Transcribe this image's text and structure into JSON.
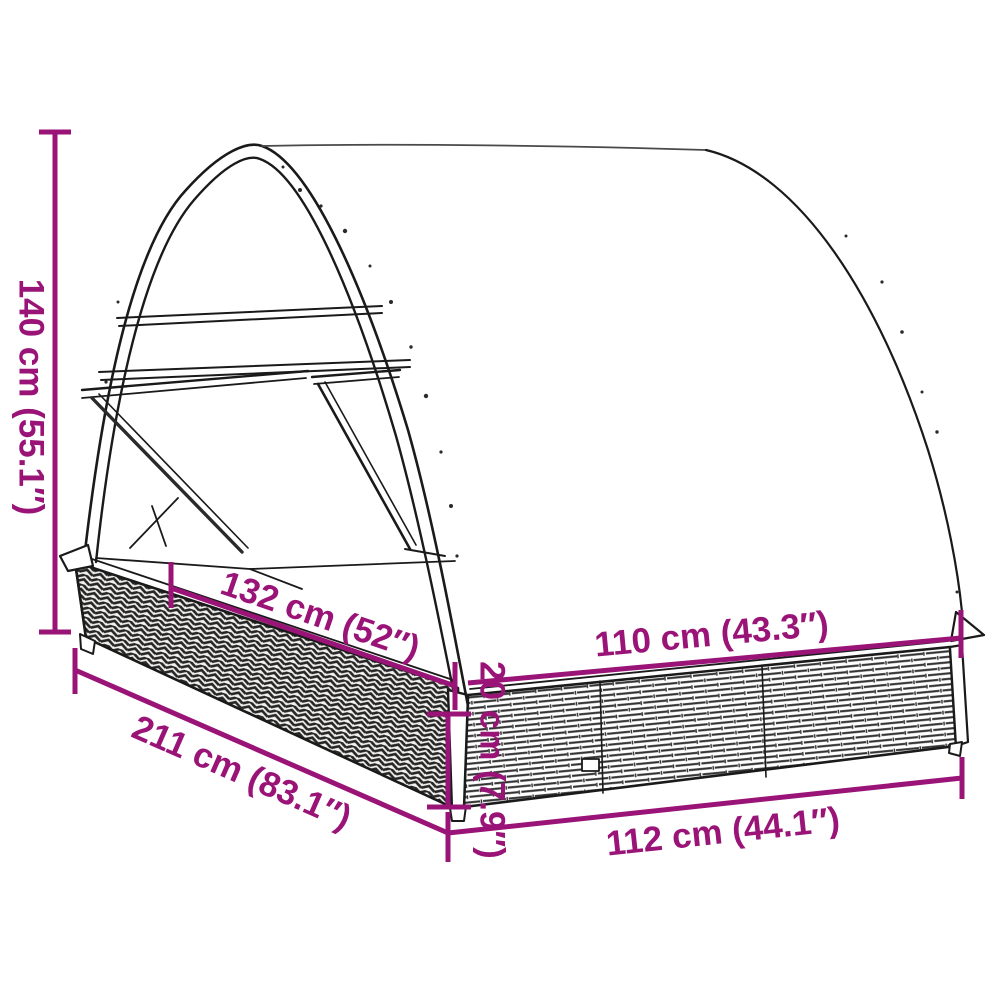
{
  "diagram": {
    "subject": "double-sun-lounger-with-round-canopy-dimension-drawing",
    "background": "#ffffff",
    "accent_color": "#9a1478",
    "line_color": "#1a1a1a",
    "dimensions": [
      {
        "id": "overall-height",
        "label": "140 cm (55.1″)",
        "value_cm": 140,
        "value_in": 55.1
      },
      {
        "id": "inner-length",
        "label": "132 cm (52″)",
        "value_cm": 132,
        "value_in": 52
      },
      {
        "id": "inner-width",
        "label": "110 cm (43.3″)",
        "value_cm": 110,
        "value_in": 43.3
      },
      {
        "id": "base-height",
        "label": "20 cm (7.9″)",
        "value_cm": 20,
        "value_in": 7.9
      },
      {
        "id": "overall-length",
        "label": "211 cm (83.1″)",
        "value_cm": 211,
        "value_in": 83.1
      },
      {
        "id": "overall-width",
        "label": "112 cm (44.1″)",
        "value_cm": 112,
        "value_in": 44.1
      }
    ]
  }
}
